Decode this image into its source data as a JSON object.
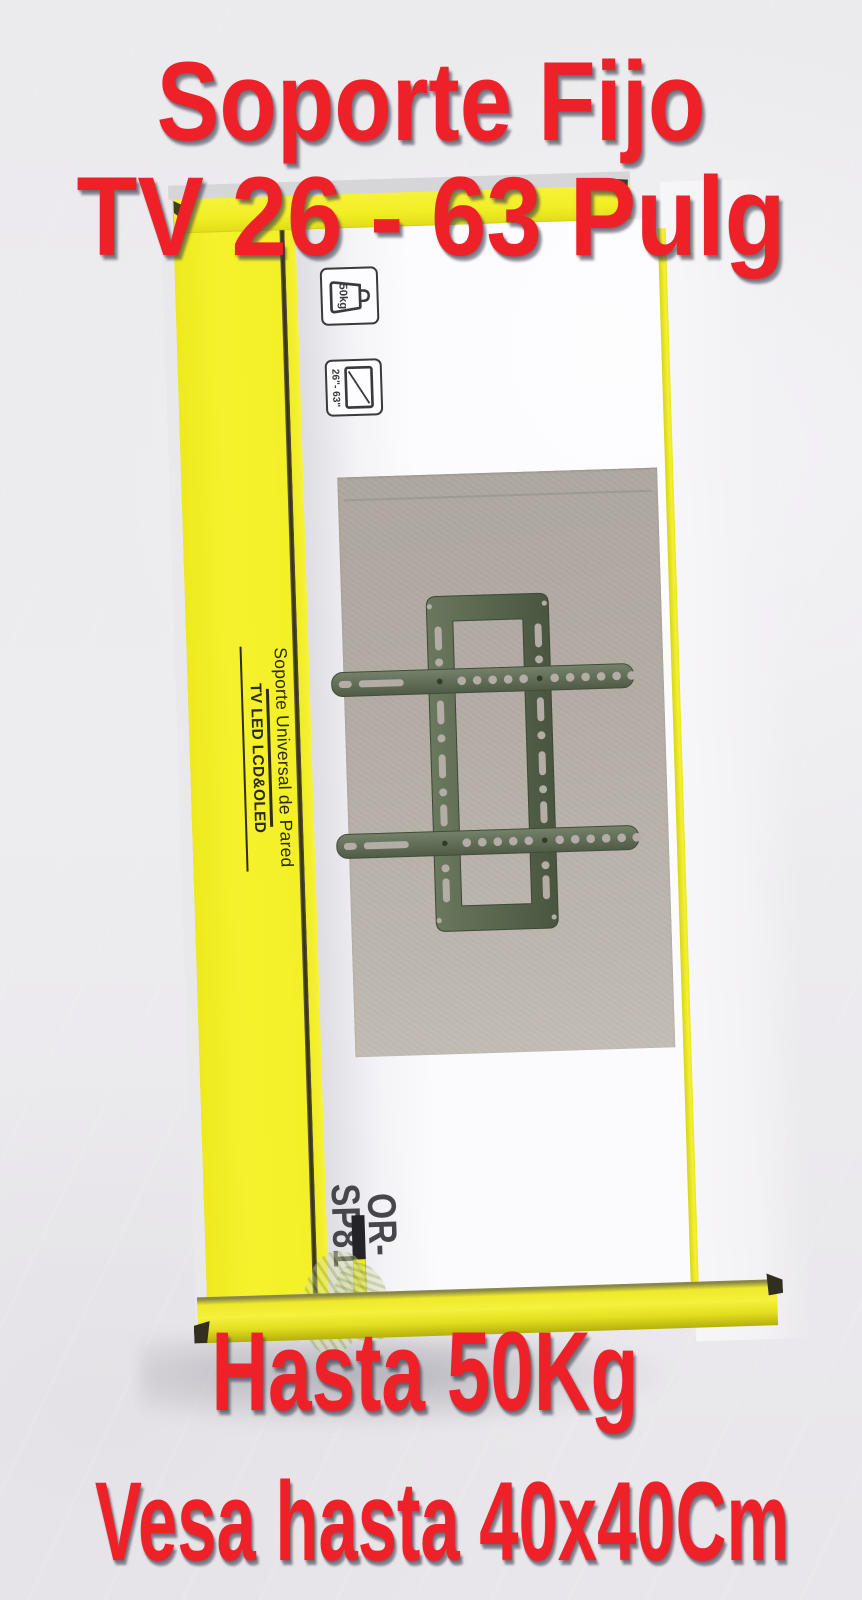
{
  "overlay": {
    "title_line1": "Soporte Fijo",
    "title_line2": "TV 26 - 63 Pulg",
    "footer_line1": "Hasta 50Kg",
    "footer_line2": "Vesa hasta 40x40Cm",
    "text_color": "#ee2028"
  },
  "box": {
    "side_band": {
      "line1": "Soporte Universal de Pared",
      "line2": "TV LED LCD&OLED"
    },
    "model_number": "OR-SP81",
    "icons": {
      "max_weight_label": "50kg",
      "screen_size_label": "26\"- 63\""
    },
    "colors": {
      "box_yellow": "#f3ef28",
      "overlay_red": "#ee2028",
      "bracket_green": "#5e6c53",
      "photo_backdrop_gray": "#b1aba3"
    }
  }
}
